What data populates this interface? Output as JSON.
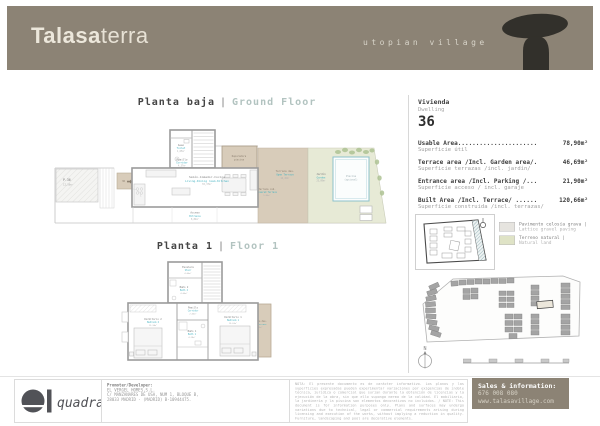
{
  "header": {
    "brand_bold": "Talasa",
    "brand_light": "terra",
    "tagline": "utopian village"
  },
  "titles": {
    "ground_es": "Planta baja",
    "sep": "|",
    "ground_en": "Ground Floor",
    "floor1_es": "Planta 1",
    "floor1_en": "Floor 1"
  },
  "ground_rooms": {
    "parking": {
      "code": "P-36",
      "area": "12,50m²"
    },
    "entry": {
      "tag": "36"
    },
    "aseo": {
      "es": "Aseo",
      "en": "Toilet",
      "area": "1,65m²"
    },
    "pasillo": {
      "es": "Pasillo",
      "en": "Corridor",
      "area": "4,37m²"
    },
    "living": {
      "es": "Salón-Comedor-Cocina",
      "en": "Living-Dining room-Kitchen",
      "area": "33,37m²"
    },
    "acceso": {
      "es": "Acceso",
      "en": "Entrance",
      "area": "8,84m²"
    },
    "depuradora": {
      "l1": "Depuradora",
      "l2": "piscina"
    },
    "terraza_cub": {
      "es": "Terraza cub.",
      "en": "Covered Terrace",
      "area": "5,84m²"
    },
    "terraza_des": {
      "es": "Terraza des.",
      "en": "Open Terrace",
      "area": "16,26m²"
    },
    "jardin": {
      "es": "Jardín",
      "en": "Garden",
      "area": "23,09m²"
    },
    "piscina": {
      "es": "Piscina",
      "en": "(opcional)"
    }
  },
  "floor1_rooms": {
    "escalera": {
      "es": "Escalera",
      "en": "Stair",
      "area": "4,06m²"
    },
    "bano2": {
      "es": "Baño 2",
      "en": "Bath 2",
      "area": "4,00m²"
    },
    "pasillo": {
      "es": "Pasillo",
      "en": "Corridor",
      "area": "2,06m²"
    },
    "bano1": {
      "es": "Baño 1",
      "en": "Bath 1",
      "area": "4,28m²"
    },
    "dorm2": {
      "es": "Dormitorio 2",
      "en": "Bedroom 2",
      "area": "12,34m²"
    },
    "dorm1": {
      "es": "Dormitorio 1",
      "en": "Bedroom 1",
      "area": "13,62m²"
    },
    "terraza": {
      "es": "Terraza des.",
      "en": "Open Terrace",
      "area": "4,80m²"
    }
  },
  "unit": {
    "es": "Vivienda",
    "en": "Dwelling",
    "number": "36"
  },
  "areas": [
    {
      "en": "Usable Area......................",
      "es": "Superficie útil",
      "value": "78,90m²"
    },
    {
      "en": "Terrace area /Incl. Garden area/.",
      "es": "Superficie terrazas /incl. jardín/",
      "value": "46,69m²"
    },
    {
      "en": "Entrance area /Incl. Parking /...",
      "es": "Superficie acceso / incl. garaje",
      "value": "21,90m²"
    },
    {
      "en": "Built Area /Incl. Terrace/ ......",
      "es": "Superficie construida /incl. terrazas/",
      "value": "120,66m²"
    }
  ],
  "legend": {
    "items": [
      {
        "es": "Pavimento celosía grava |",
        "en": "Lattice gravel paving",
        "color": "#e6e4df"
      },
      {
        "es": "Terreno natural |",
        "en": "Natural land",
        "color": "#dfe3c6"
      }
    ]
  },
  "compass": {
    "label": "N"
  },
  "footer": {
    "logo": "quadratia",
    "promoter_title": "Promoter/Developer:",
    "promoter_lines": [
      "EL VERGEL HOMES,S.L.",
      "C/ MANZANARES DE USA, NUM 1, BLOQUE B,",
      "28033 MADRID - (MADRID) B-10944475."
    ],
    "disclaimer": "NOTA: El presente documento es de carácter informativo. Los planos y las superficies expresadas pueden experimentar variaciones por exigencias de índole técnica, jurídica o comercial que surjan durante la obtención de licencias y la ejecución de la obra, sin que ello suponga merma de la calidad. El mobiliario, la jardinería y la piscina son elementos decorativos no incluidos. / NOTE: This document is for information purposes only. Plans and surfaces may undergo variations due to technical, legal or commercial requirements arising during licensing and execution of the works, without implying a reduction in quality. Furniture, landscaping and pool are decorative elements.",
    "sales": {
      "title": "Sales & information:",
      "phone": "676 008 080",
      "web": "www.talasavillage.com"
    }
  },
  "colors": {
    "header_taupe": "#8c8375",
    "teal_label": "#45b3c2",
    "terrace_fill": "#d8ccba",
    "garden_fill": "#e7ead6",
    "pool_stroke": "#8ec1cb"
  }
}
